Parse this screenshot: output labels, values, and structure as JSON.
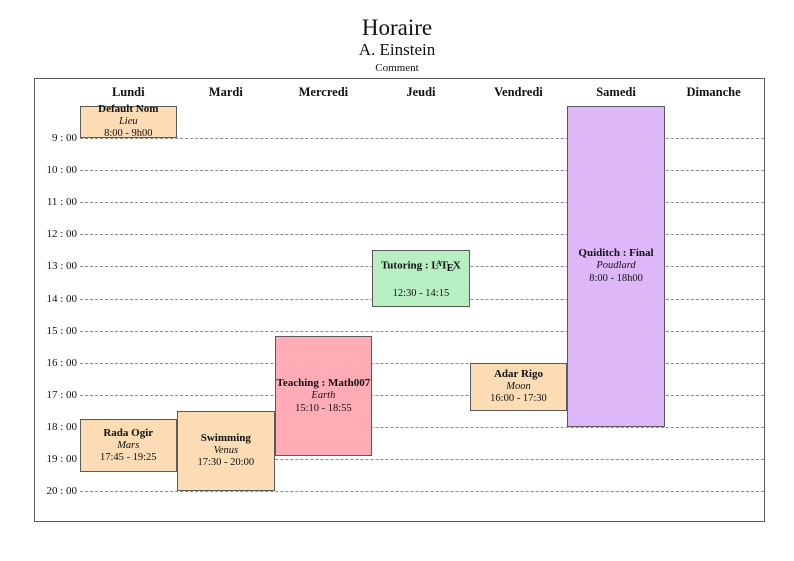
{
  "header": {
    "title": "Horaire",
    "subtitle": "A. Einstein",
    "comment": "Comment"
  },
  "colors": {
    "event_peach": "#FBDCB4",
    "event_pink": "#FFACB7",
    "event_green": "#B7EFC3",
    "event_purple": "#DDB7F8",
    "block_border": "#5a5a5a",
    "grid_dash": "#8a8a8a",
    "frame_border": "#5a5a5a",
    "text": "#111111"
  },
  "chart_data": {
    "type": "table",
    "title": "Horaire",
    "subtitle": "A. Einstein",
    "comment": "Comment",
    "layout_hints": {
      "grid": "horizontal dashed hour lines only, no vertical column lines",
      "first_labeled_hour": 9,
      "last_labeled_hour": 20,
      "content_starts_hour": 8
    },
    "columns": [
      "Lundi",
      "Mardi",
      "Mercredi",
      "Jeudi",
      "Vendredi",
      "Samedi",
      "Dimanche"
    ],
    "time_ticks": [
      "9 : 00",
      "10 : 00",
      "11 : 00",
      "12 : 00",
      "13 : 00",
      "14 : 00",
      "15 : 00",
      "16 : 00",
      "17 : 00",
      "18 : 00",
      "19 : 00",
      "20 : 00"
    ],
    "tick_hours": [
      9,
      10,
      11,
      12,
      13,
      14,
      15,
      16,
      17,
      18,
      19,
      20
    ],
    "events": [
      {
        "day": "Lundi",
        "day_index": 0,
        "title": "Default Nom",
        "location": "Lieu",
        "time_label": "8:00 - 9h00",
        "start_hour": 8.0,
        "end_hour": 9.0,
        "fill": "#FBDCB4"
      },
      {
        "day": "Lundi",
        "day_index": 0,
        "title": "Rada Ogir",
        "location": "Mars",
        "time_label": "17:45 - 19:25",
        "start_hour": 17.75,
        "end_hour": 19.4167,
        "fill": "#FBDCB4"
      },
      {
        "day": "Mardi",
        "day_index": 1,
        "title": "Swimming",
        "location": "Venus",
        "time_label": "17:30 - 20:00",
        "start_hour": 17.5,
        "end_hour": 20.0,
        "fill": "#FBDCB4"
      },
      {
        "day": "Mercredi",
        "day_index": 2,
        "title": "Teaching : Math007",
        "location": "Earth",
        "time_label": "15:10 - 18:55",
        "start_hour": 15.1667,
        "end_hour": 18.9167,
        "fill": "#FFACB7"
      },
      {
        "day": "Jeudi",
        "day_index": 3,
        "title": "Tutoring : LaTeX",
        "latex_token": "LaTeX",
        "location": "",
        "time_label": "12:30 - 14:15",
        "start_hour": 12.5,
        "end_hour": 14.25,
        "fill": "#B7EFC3"
      },
      {
        "day": "Vendredi",
        "day_index": 4,
        "title": "Adar Rigo",
        "location": "Moon",
        "time_label": "16:00 - 17:30",
        "start_hour": 16.0,
        "end_hour": 17.5,
        "fill": "#FBDCB4"
      },
      {
        "day": "Samedi",
        "day_index": 5,
        "title": "Quiditch : Final",
        "location": "Poudlard",
        "time_label": "8:00 - 18h00",
        "start_hour": 8.0,
        "end_hour": 18.0,
        "fill": "#DDB7F8"
      }
    ]
  }
}
